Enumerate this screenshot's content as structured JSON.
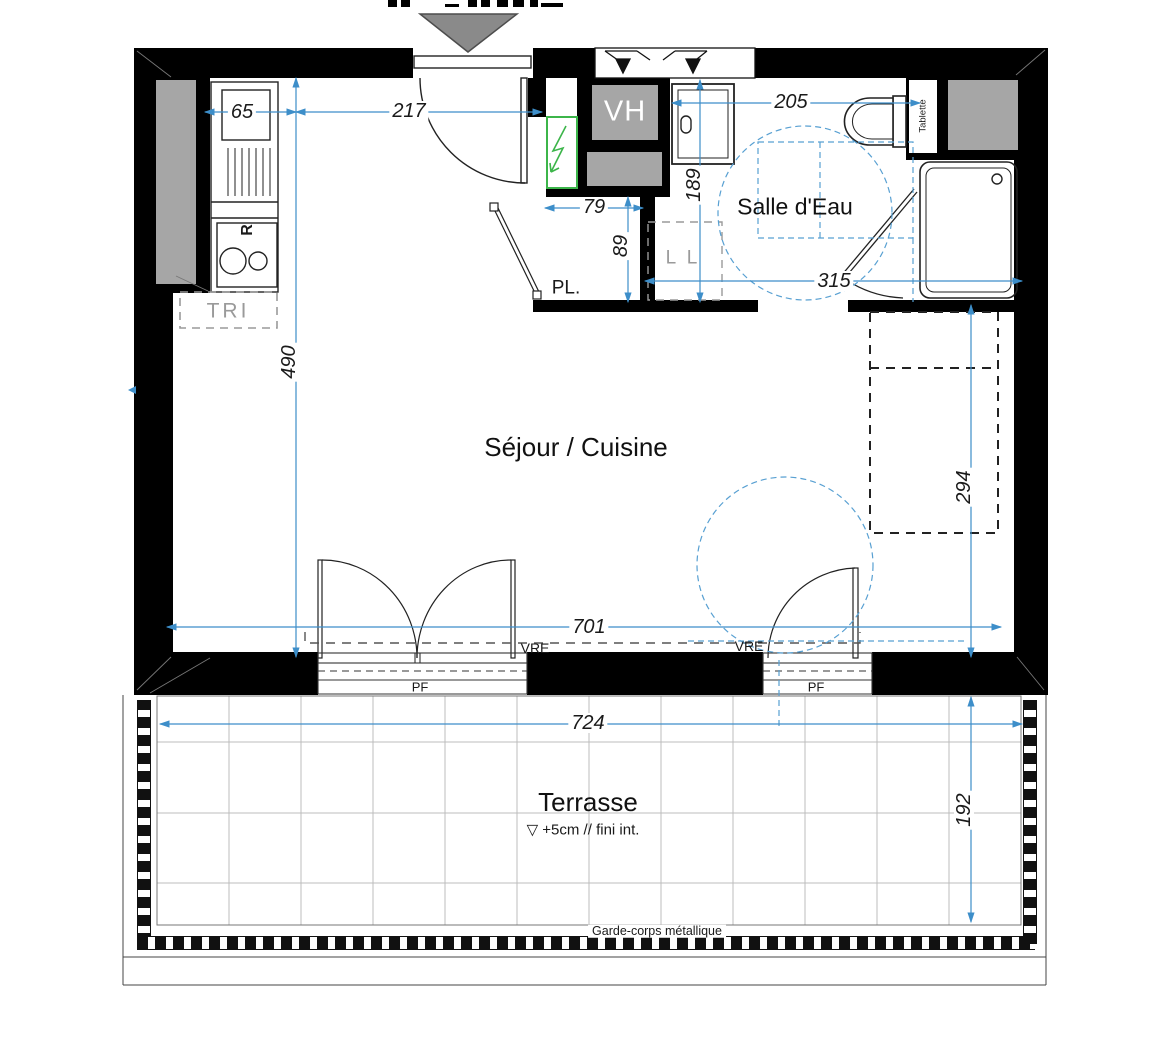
{
  "plan": {
    "rooms": {
      "living": "Séjour / Cuisine",
      "bathroom": "Salle d'Eau",
      "terrace": "Terrasse"
    },
    "labels": {
      "closet": "PL.",
      "waste_sorting": "TRI",
      "washing_machine": "L L",
      "vent_shaft": "VH",
      "shelf": "Tablette",
      "fridge": "R",
      "roller_shutter": "VRE",
      "french_window": "PF",
      "railing": "Garde-corps métallique",
      "level_symbol": "▽",
      "level_note": "+5cm // fini int."
    },
    "dimensions": {
      "d65": "65",
      "d217": "217",
      "d79": "79",
      "d89": "89",
      "d205": "205",
      "d189": "189",
      "d315": "315",
      "d490": "490",
      "d701": "701",
      "d294": "294",
      "d724": "724",
      "d192": "192"
    },
    "colors": {
      "wall": "#000000",
      "duct_gray": "#a6a6a6",
      "dimension_blue": "#3d8ec9",
      "accessibility_blue": "#58a0d2",
      "electrical_green": "#3cb54a",
      "entry_marker_gray": "#8a8a8a",
      "tile_grid_gray": "#bcbcbc"
    }
  }
}
